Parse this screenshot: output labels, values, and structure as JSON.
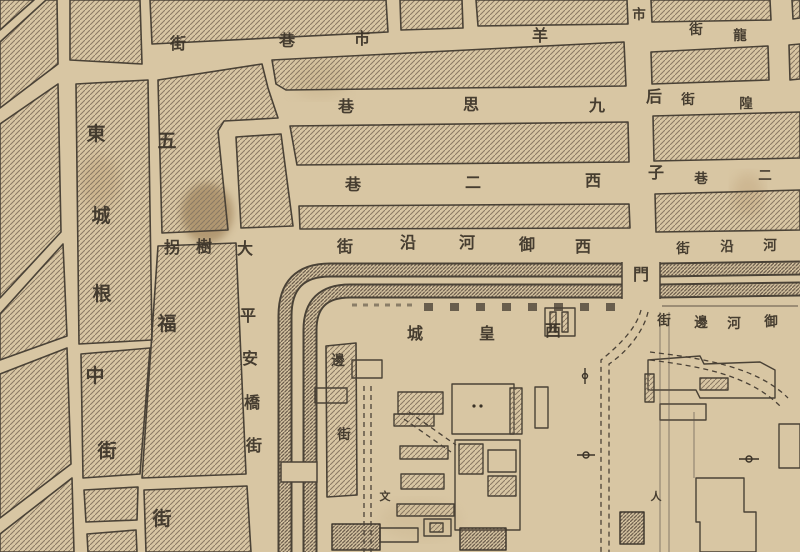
{
  "map": {
    "kind": "historical-city-map",
    "colors": {
      "paper": "#d8c6a3",
      "ink": "#3a3227",
      "hatch": "#8a7963",
      "wall_hatch": "#6b5c4a",
      "stain": "#8a6a3f"
    },
    "labels": {
      "dongchenggen": {
        "name": "東城根中街",
        "orientation": "vertical",
        "chars": [
          "東",
          "城",
          "根",
          "中",
          "街"
        ]
      },
      "wufujie": {
        "name": "五福街",
        "orientation": "vertical",
        "chars": [
          "五",
          "福",
          "街"
        ]
      },
      "dashuguai": {
        "name": "大樹拐",
        "orientation": "rtl-horizontal",
        "chars": [
          "拐",
          "樹",
          "大"
        ]
      },
      "pinganqiao": {
        "name": "平安橋街",
        "orientation": "vertical",
        "chars": [
          "平",
          "安",
          "橋",
          "街"
        ]
      },
      "yangshixiang": {
        "name": "羊市巷",
        "orientation": "rtl-horizontal",
        "chars": [
          "巷",
          "市",
          "羊"
        ]
      },
      "jie_frag": {
        "name": "街",
        "orientation": "fragment",
        "chars": [
          "街"
        ]
      },
      "jiusixiang": {
        "name": "九思巷",
        "orientation": "rtl-horizontal",
        "chars": [
          "巷",
          "思",
          "九"
        ]
      },
      "xierxiang": {
        "name": "西二巷",
        "orientation": "rtl-horizontal",
        "chars": [
          "巷",
          "二",
          "西"
        ]
      },
      "xiyuhe": {
        "name": "西御河沿街",
        "orientation": "rtl-horizontal",
        "chars": [
          "街",
          "沿",
          "河",
          "御",
          "西"
        ]
      },
      "xihuangcheng": {
        "name": "西皇城",
        "orientation": "rtl-horizontal",
        "chars": [
          "城",
          "皇",
          "西"
        ]
      },
      "bianjie": {
        "name": "邊街",
        "orientation": "vertical",
        "chars": [
          "邊",
          "街"
        ]
      },
      "houzimen": {
        "name": "后子門",
        "orientation": "vertical",
        "chars": [
          "后",
          "子",
          "門"
        ]
      },
      "shi_frag": {
        "name": "市",
        "orientation": "fragment",
        "chars": [
          "市"
        ]
      },
      "long_frag": {
        "name": "龍街",
        "orientation": "rtl-horizontal",
        "chars": [
          "街",
          "龍"
        ]
      },
      "huang_frag": {
        "name": "隍街",
        "orientation": "rtl-horizontal",
        "chars": [
          "街",
          "隍"
        ]
      },
      "erxiang_frag": {
        "name": "二巷",
        "orientation": "rtl-horizontal",
        "chars": [
          "巷",
          "二"
        ]
      },
      "dongyuhe": {
        "name": "河沿街",
        "orientation": "rtl-horizontal",
        "chars": [
          "街",
          "沿",
          "河"
        ]
      },
      "yuhebianjie": {
        "name": "御河邊街",
        "orientation": "rtl-horizontal",
        "chars": [
          "街",
          "邊",
          "河",
          "御"
        ]
      },
      "wen_mark": {
        "name": "文",
        "orientation": "fragment",
        "chars": [
          "文"
        ]
      },
      "ren_mark": {
        "name": "人",
        "orientation": "fragment",
        "chars": [
          "人"
        ]
      }
    }
  }
}
